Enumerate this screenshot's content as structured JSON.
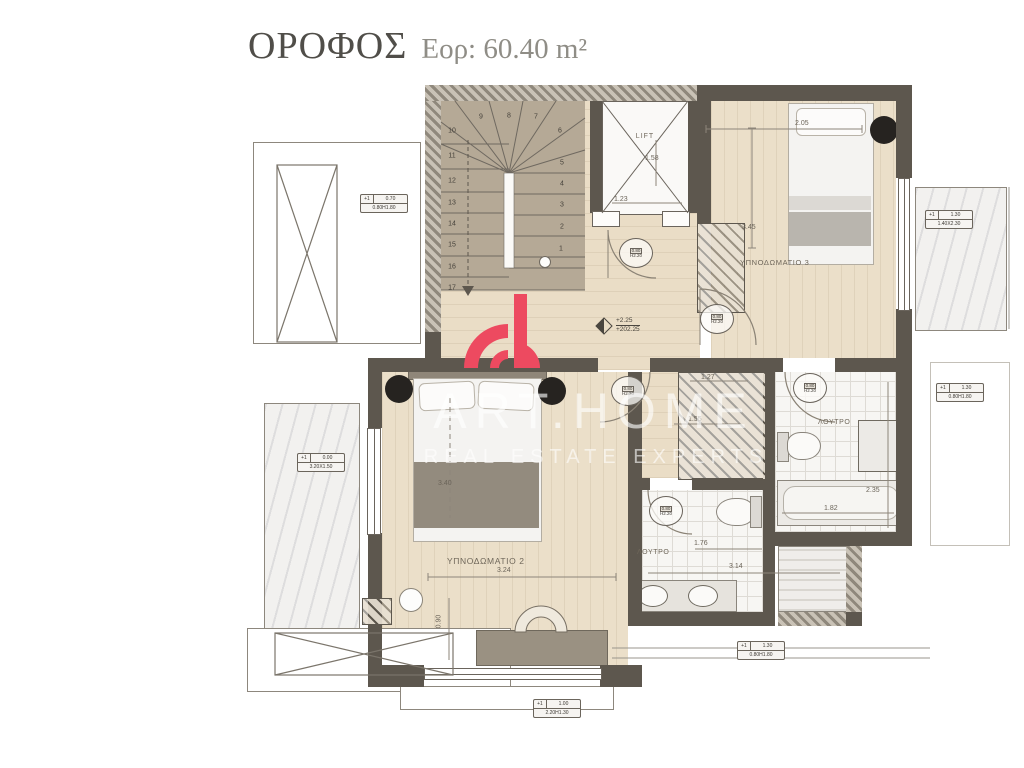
{
  "title": {
    "name": "ΟΡΟΦΟΣ",
    "area": "Εορ: 60.40 m²"
  },
  "watermark": {
    "brand": "ART.HOME",
    "tagline": "REAL ESTATE EXPERTS"
  },
  "rooms": {
    "bedroom3": "ΥΠΝΟΔΩΜΑΤΙΟ 3",
    "bedroom2": "ΥΠΝΟΔΩΜΑΤΙΟ 2",
    "bath_upper": "ΛΟΥΤΡΟ",
    "bath_lower": "ΛΟΥΤΡΟ",
    "lift": "LIFT"
  },
  "levels": {
    "relative": "+2.25",
    "absolute": "+202.25"
  },
  "dimensions": {
    "bedroom3_depth": "3.45",
    "bedroom3_bed": "2.05",
    "lift_depth": "1.58",
    "lift_width": "1.23",
    "closet_a": "1.27",
    "closet_b": "1.55",
    "bedroom2_depth": "3.40",
    "bedroom2_width": "3.24",
    "bedroom2_desk": "0.90",
    "bath_lower_width": "1.76",
    "terrace_width": "3.14",
    "bath_upper_depth": "2.35",
    "bath_upper_width": "1.82"
  },
  "stairs": {
    "numbers": [
      "1",
      "2",
      "3",
      "4",
      "5",
      "6",
      "7",
      "8",
      "9",
      "10",
      "11",
      "12",
      "13",
      "14",
      "15",
      "16",
      "17"
    ]
  },
  "door_tag": {
    "line1": "0.80",
    "line2": "Η2.20"
  },
  "window_tags": [
    {
      "c1": "+1",
      "c2": "0.70",
      "size": "0.80Η1.80"
    },
    {
      "c1": "+1",
      "c2": "1.30",
      "size": "1.40Χ2.30"
    },
    {
      "c1": "+1",
      "c2": "1.30",
      "size": "0.80Η1.80"
    },
    {
      "c1": "+1",
      "c2": "0.00",
      "size": "3.20Χ1.50"
    },
    {
      "c1": "+1",
      "c2": "1.00",
      "size": "2.20Η1.30"
    },
    {
      "c1": "+1",
      "c2": "1.30",
      "size": "0.80Η1.80"
    }
  ],
  "colors": {
    "wall": "#5D574E",
    "floor": "#EBDFC9",
    "accent": "#ED4A60"
  }
}
